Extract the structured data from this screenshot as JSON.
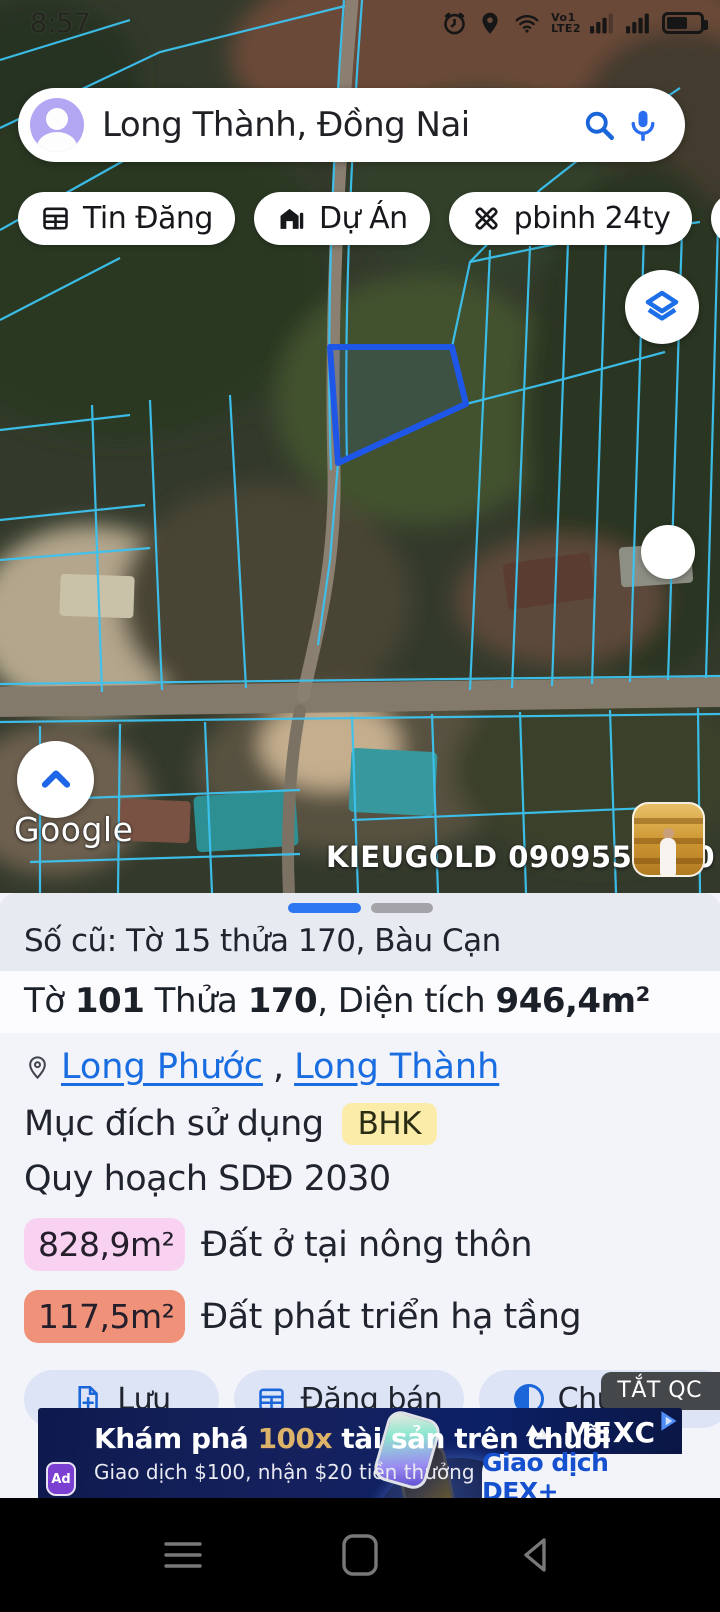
{
  "status_bar": {
    "time": "8:57",
    "volte_line1": "Vo1",
    "volte_line2": "LTE2"
  },
  "search": {
    "query": "Long Thành, Đồng Nai"
  },
  "chips": [
    {
      "label": "Tin Đăng"
    },
    {
      "label": "Dự Án"
    },
    {
      "label": "pbinh 24ty"
    },
    {
      "label": "mtp"
    }
  ],
  "map": {
    "google_watermark": "Google",
    "overlay_ad_text": "KIEUGOLD 0909556600",
    "selected_parcel_color": "#1e57e8",
    "cadastral_line_color": "#3cc3f0"
  },
  "sheet": {
    "old_parcel": "Số cũ: Tờ 15 thửa 170, Bàu Cạn",
    "parcel": {
      "t1": "Tờ ",
      "sheet_no": "101",
      "t2": " Thửa ",
      "plot_no": "170",
      "t3": ", Diện tích ",
      "area": "946,4m²"
    },
    "location": {
      "link1": "Long Phước",
      "separator": ", ",
      "link2": "Long Thành"
    },
    "purpose_label": "Mục đích sử dụng",
    "purpose_code": "BHK",
    "purpose_badge_color": "#fbeca9",
    "plan_line": "Quy hoạch SDĐ 2030",
    "zones": [
      {
        "area": "828,9m²",
        "label": "Đất ở tại nông thôn",
        "color": "#f9d2f2"
      },
      {
        "area": "117,5m²",
        "label": "Đất phát triển hạ tầng",
        "color": "#f0927a"
      }
    ],
    "buttons": [
      {
        "label": "Lưu"
      },
      {
        "label": "Đăng bán"
      },
      {
        "label": "Chú thích"
      }
    ]
  },
  "ad_banner": {
    "dismiss_label": "TẮT QC",
    "headline_pre": "Khám phá ",
    "headline_highlight": "100x",
    "headline_post": " tài sản trên chuỗi",
    "highlight_color": "#ddb269",
    "subline": "Giao dịch $100, nhận $20 tiền thưởng",
    "brand": "MEXC",
    "cta": "Giao dịch DEX+",
    "ad_badge": "Ad"
  }
}
